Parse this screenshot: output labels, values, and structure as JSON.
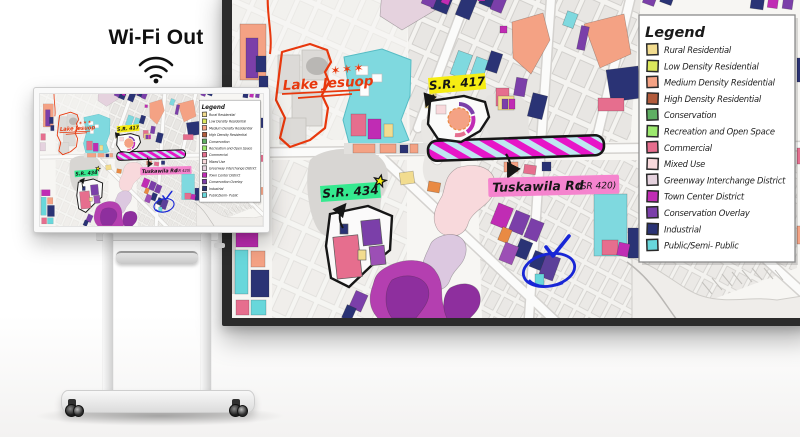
{
  "scene": {
    "wifi_label": "Wi-Fi Out"
  },
  "map": {
    "annotations": {
      "lake_label": "Lake Jesuop",
      "lake_stars": "✶✶✶",
      "sr417_label": "S.R. 417",
      "sr434_label": "S.R. 434",
      "road_label": "Tuskawila Rd",
      "road_label_suffix": "(SR 420)"
    },
    "annotation_colors": {
      "red_ink": "#E8380D",
      "yellow_highlight": "#F6ED13",
      "green_highlight": "#35E98F",
      "pink_highlight": "#F584CE",
      "blue_ink": "#1826D6",
      "magenta_hatch": "#E715C8",
      "black_ink": "#161616"
    }
  },
  "legend": {
    "title": "Legend",
    "items": [
      {
        "label": "Rural Residential",
        "color": "#F2DC8F"
      },
      {
        "label": "Low Density Residential",
        "color": "#DCE85C"
      },
      {
        "label": "Medium Density Residential",
        "color": "#F4A284"
      },
      {
        "label": "High Density Residential",
        "color": "#B25B3C"
      },
      {
        "label": "Conservation",
        "color": "#5FAF63"
      },
      {
        "label": "Recreation and Open Space",
        "color": "#9CE96E"
      },
      {
        "label": "Commercial",
        "color": "#E66E8E"
      },
      {
        "label": "Mixed Use",
        "color": "#F8D9DC"
      },
      {
        "label": "Greenway Interchange District",
        "color": "#E5D2DE"
      },
      {
        "label": "Town Center District",
        "color": "#C02CB4"
      },
      {
        "label": "Conservation Overlay",
        "color": "#7B3FA9"
      },
      {
        "label": "Industrial",
        "color": "#2A3375"
      },
      {
        "label": "Public/Semi- Public",
        "color": "#68D7DB"
      }
    ]
  }
}
